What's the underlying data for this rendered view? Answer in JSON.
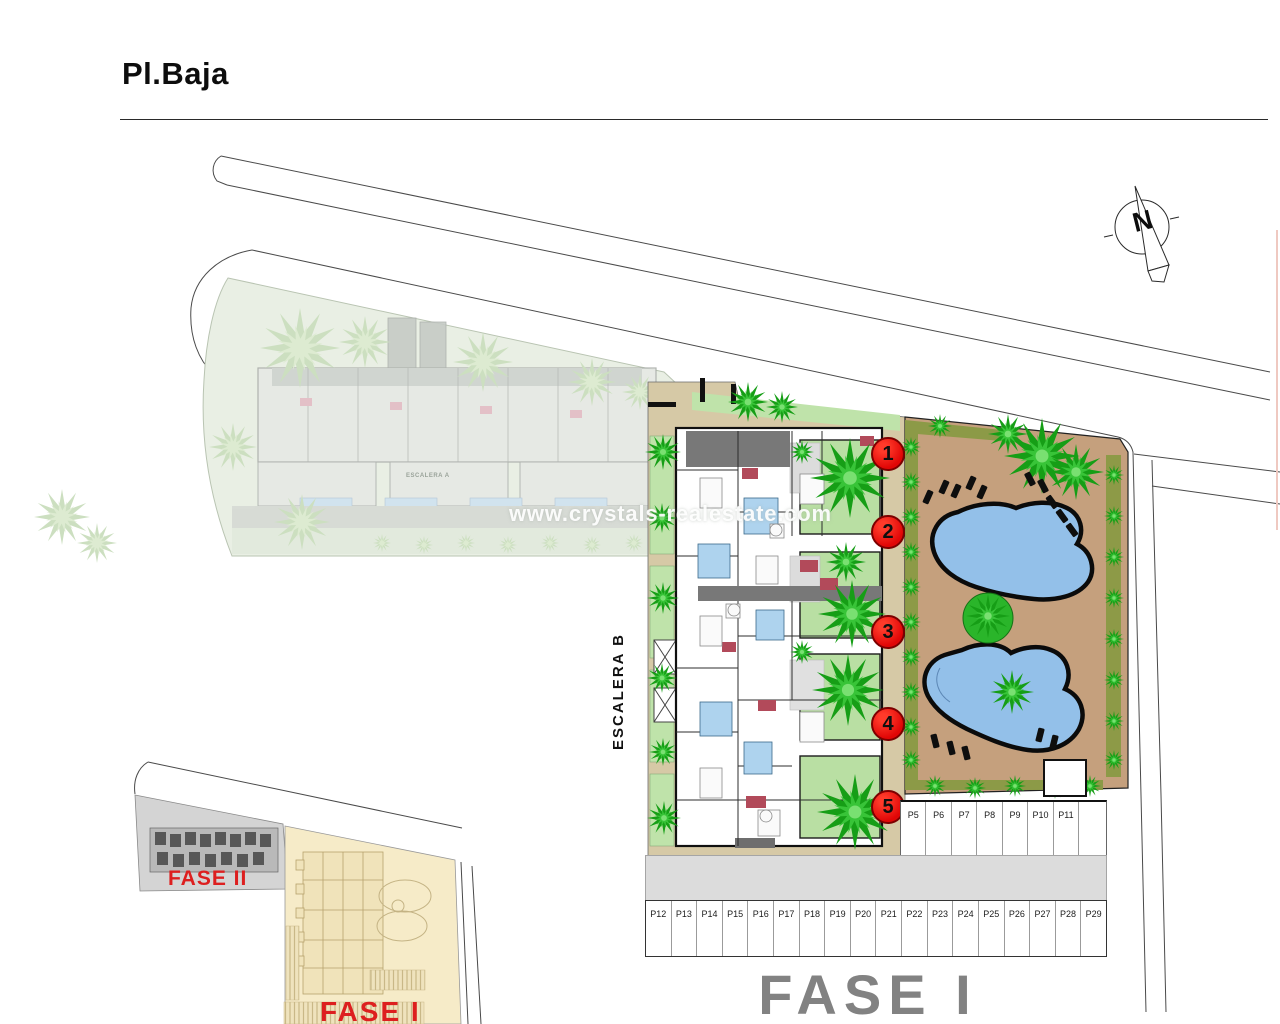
{
  "page": {
    "title": "Pl.Baja"
  },
  "compass": {
    "label": "N"
  },
  "watermark": {
    "text": "www.crystals-realestate.com"
  },
  "plan": {
    "stair_label_b": "ESCALERA B",
    "stair_label_a": "ESCALERA A",
    "unit_markers": [
      "1",
      "2",
      "3",
      "4",
      "5"
    ]
  },
  "parking": {
    "top_row": [
      "P5",
      "P6",
      "P7",
      "P8",
      "P9",
      "P10",
      "P11"
    ],
    "bottom_row": [
      "P12",
      "P13",
      "P14",
      "P15",
      "P16",
      "P17",
      "P18",
      "P19",
      "P20",
      "P21",
      "P22",
      "P23",
      "P24",
      "P25",
      "P26",
      "P27",
      "P28",
      "P29"
    ]
  },
  "labels": {
    "phase_main": "FASE I",
    "inset_phase2": "FASE II",
    "inset_phase1": "FASE I"
  },
  "colors": {
    "marker_red": "#e00606",
    "phase_text_red": "#dd1f1f",
    "phase_main_gray": "#828282",
    "pool_blue": "#93c0e9",
    "garden_green": "#b9dfa3",
    "tree_green": "#1ea21e",
    "sand_tan": "#d6c9a6",
    "pool_deck_tan": "#c5a07d",
    "olive_strip": "#8a9a45",
    "faded_green": "#e9efe4"
  }
}
